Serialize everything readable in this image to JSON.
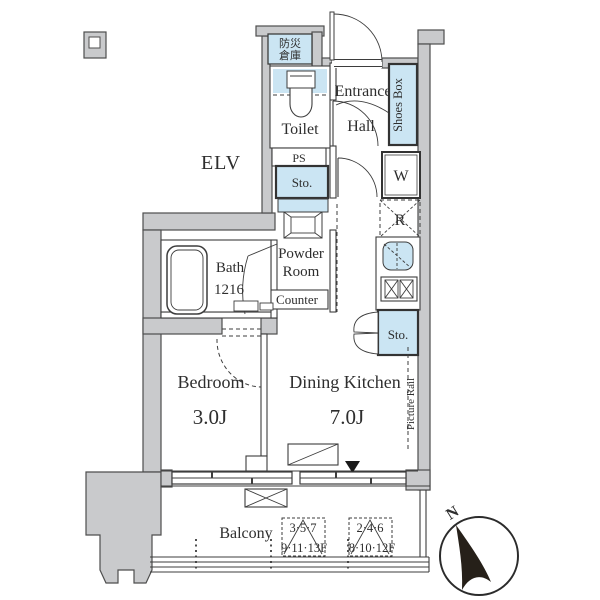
{
  "labels": {
    "elv": "ELV",
    "bousai1": "防災",
    "bousai2": "倉庫",
    "toilet": "Toilet",
    "entrance": "Entrance",
    "hall": "Hall",
    "shoes_box": "Shoes Box",
    "ps": "PS",
    "sto_upper": "Sto.",
    "washer": "W",
    "fridge": "R",
    "powder1": "Powder",
    "powder2": "Room",
    "counter": "Counter",
    "bath": "Bath",
    "bath_size": "1216",
    "sto_lower": "Sto.",
    "bedroom": "Bedroom",
    "bedroom_size": "3.0J",
    "dining_kitchen": "Dining Kitchen",
    "dining_kitchen_size": "7.0J",
    "picture_rail": "Picture Rail",
    "balcony": "Balcony",
    "floors_a1": "3·5·7",
    "floors_a2": "9·11·13F",
    "floors_b1": "2·4·6",
    "floors_b2": "8·10·12F",
    "north": "N"
  },
  "colors": {
    "wall_gray": "#c9cacc",
    "fixture_blue": "#cbe5f3",
    "line": "#3d3d3d"
  }
}
